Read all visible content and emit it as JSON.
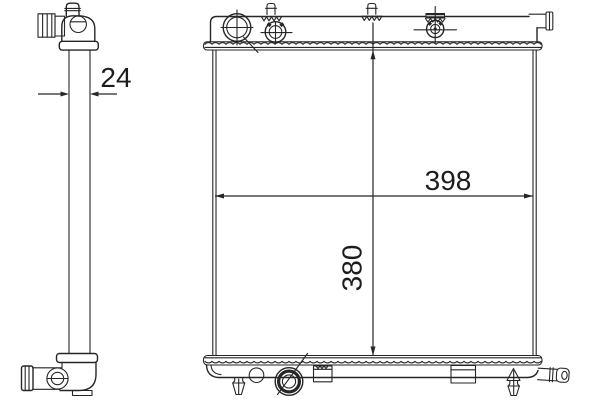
{
  "style": {
    "background": "#ffffff",
    "line_color": "#262626",
    "text_color": "#1c1c1c"
  },
  "drawing": {
    "dimensions": {
      "depth": {
        "label": "24"
      },
      "width": {
        "label": "398"
      },
      "height": {
        "label": "380"
      }
    }
  }
}
